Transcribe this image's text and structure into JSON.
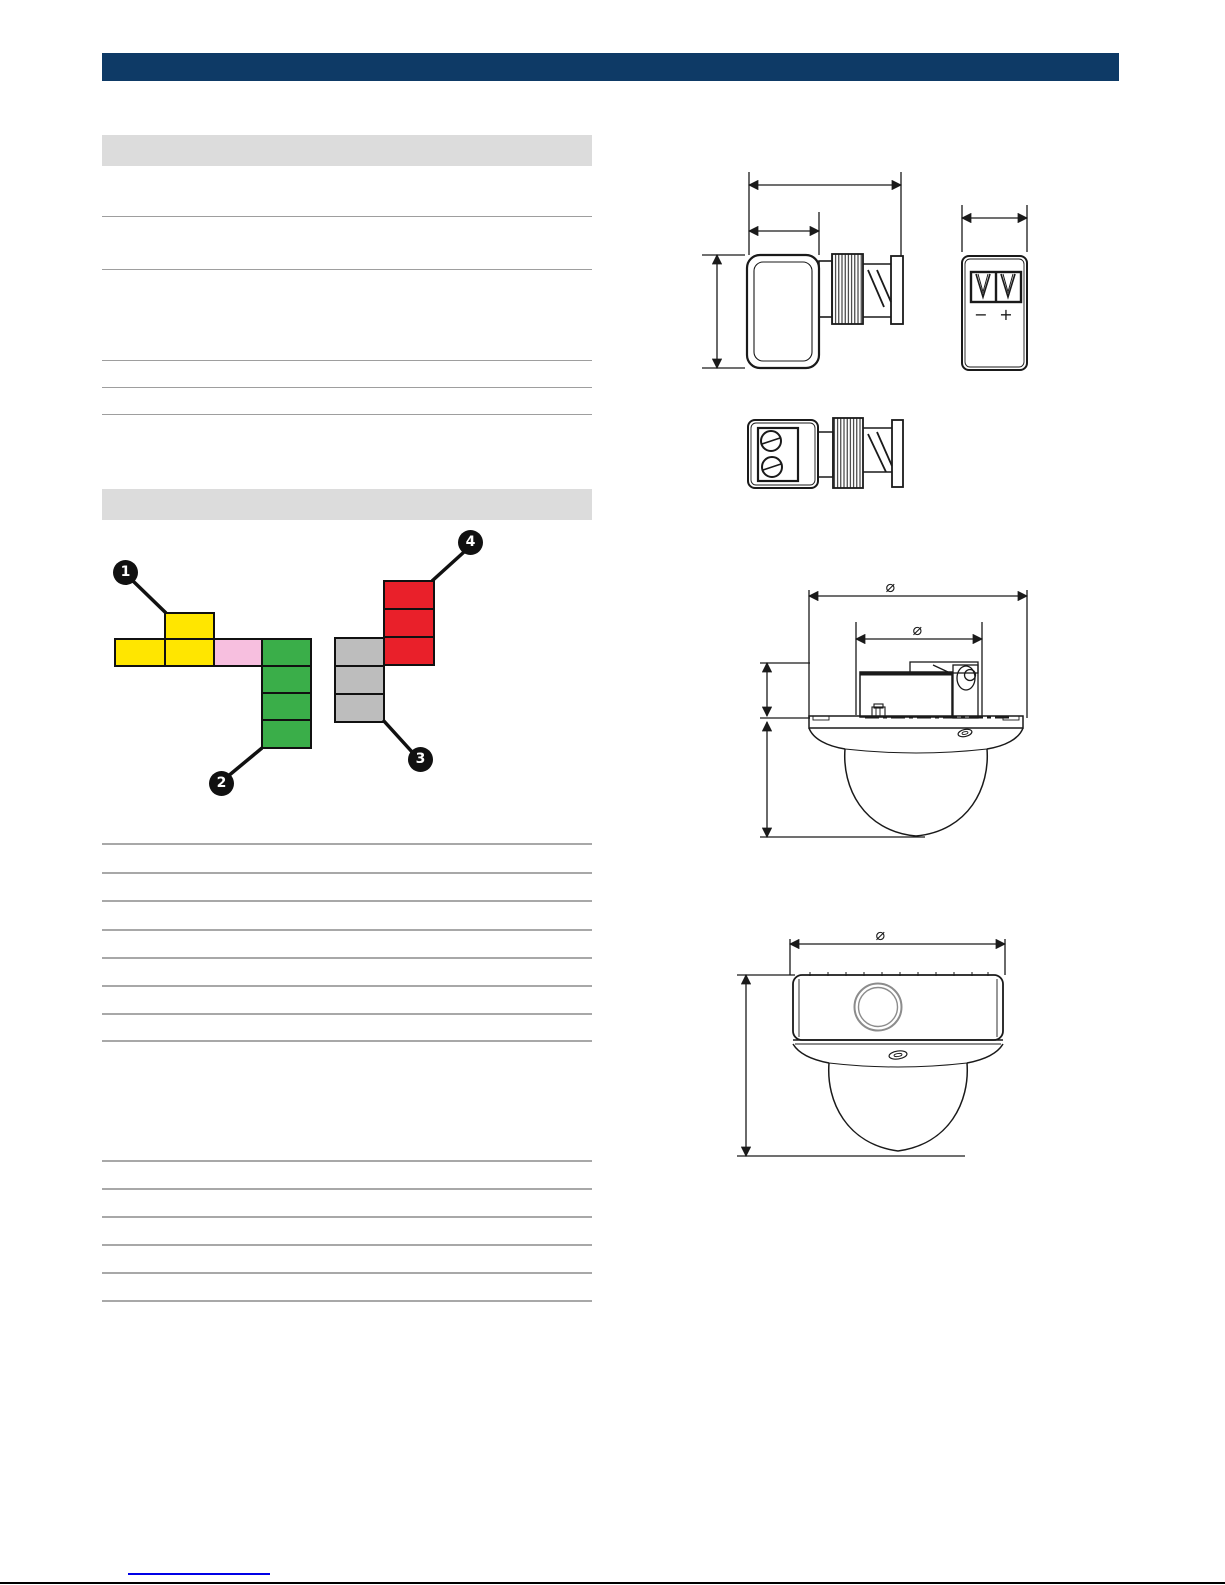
{
  "page": {
    "background_color": "#ffffff",
    "top_bar_color": "#0e3a66",
    "section_header_color": "#dcdcdc",
    "table_rule_color": "#a8a8a8",
    "footer_rule_color": "#000000",
    "footer_link_color": "#0000e6"
  },
  "diagram": {
    "callouts": [
      {
        "label": "1"
      },
      {
        "label": "2"
      },
      {
        "label": "3"
      },
      {
        "label": "4"
      }
    ],
    "colors": {
      "yellow": "#ffe600",
      "pink": "#f7bfdf",
      "green": "#3aae49",
      "red": "#e9202a",
      "gray": "#bdbdbd"
    }
  },
  "drawings": {
    "diameter_symbol": "⌀",
    "minus_label": "−",
    "plus_label": "+"
  }
}
